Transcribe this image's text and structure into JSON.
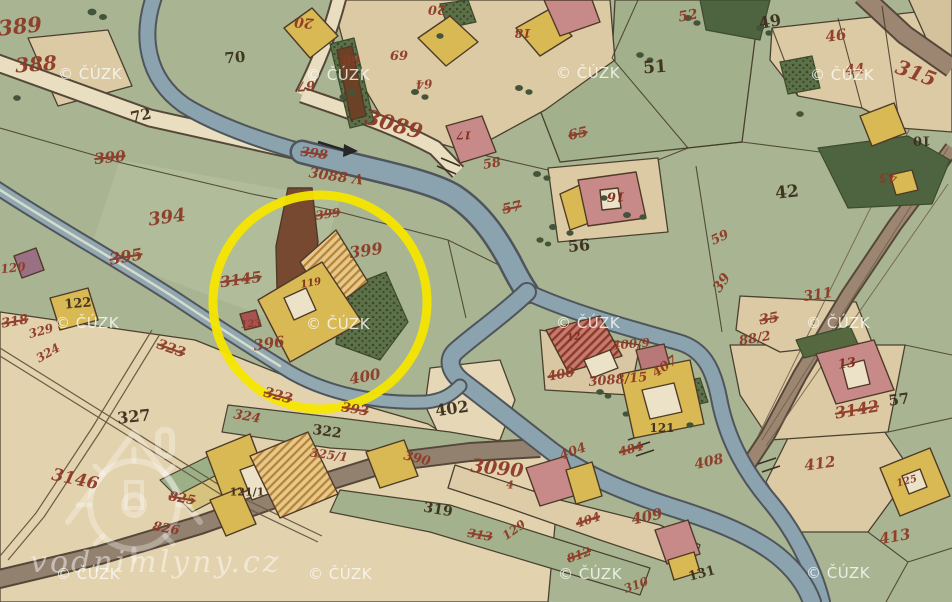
{
  "palette": {
    "field_green": "#a9b592",
    "parcel_beige": "#dccaa4",
    "road_beige": "#e9debf",
    "road_brown": "#9c8672",
    "water_blue": "#8ba3ae",
    "building_yellow": "#d9b954",
    "building_pink": "#c88a88",
    "garden_dark_green": "#5d7148",
    "number_red": "#8d3a27",
    "number_black": "#3b2e1e",
    "highlight_yellow": "#f6e600"
  },
  "highlight": {
    "shape": "circle",
    "cx": 320,
    "cy": 302,
    "r": 107,
    "color": "#f6e600",
    "stroke_width": 9
  },
  "watermark": {
    "text": "© ČÚZK",
    "positions": [
      {
        "x": 90,
        "y": 74
      },
      {
        "x": 338,
        "y": 75
      },
      {
        "x": 588,
        "y": 73
      },
      {
        "x": 842,
        "y": 75
      },
      {
        "x": 87,
        "y": 323
      },
      {
        "x": 338,
        "y": 324
      },
      {
        "x": 588,
        "y": 323
      },
      {
        "x": 838,
        "y": 323
      },
      {
        "x": 88,
        "y": 574
      },
      {
        "x": 340,
        "y": 574
      },
      {
        "x": 590,
        "y": 574
      },
      {
        "x": 838,
        "y": 573
      }
    ]
  },
  "logo": {
    "text": "vodnimlyny.cz"
  },
  "map": {
    "labels": [
      {
        "t": "389",
        "x": 20,
        "y": 26,
        "c": "red",
        "s": 21,
        "r": -6
      },
      {
        "t": "388",
        "x": 36,
        "y": 64,
        "c": "red",
        "s": 20,
        "r": -4
      },
      {
        "t": "72",
        "x": 141,
        "y": 116,
        "c": "black",
        "s": 15,
        "r": -12
      },
      {
        "t": "70",
        "x": 235,
        "y": 58,
        "c": "black",
        "s": 15,
        "r": -5
      },
      {
        "t": "20",
        "x": 304,
        "y": 22,
        "c": "red",
        "s": 14,
        "r": 185
      },
      {
        "t": "20",
        "x": 437,
        "y": 9,
        "c": "red",
        "s": 13,
        "r": 180
      },
      {
        "t": "66",
        "x": 351,
        "y": 59,
        "c": "red",
        "s": 13,
        "r": 175
      },
      {
        "t": "69",
        "x": 399,
        "y": 54,
        "c": "red",
        "s": 13,
        "r": 180
      },
      {
        "t": "64",
        "x": 424,
        "y": 84,
        "c": "red",
        "s": 12,
        "r": 175
      },
      {
        "t": "67",
        "x": 306,
        "y": 85,
        "c": "red",
        "s": 13,
        "r": 175
      },
      {
        "t": "18",
        "x": 523,
        "y": 33,
        "c": "red",
        "s": 12,
        "r": 180
      },
      {
        "t": "52",
        "x": 688,
        "y": 16,
        "c": "red",
        "s": 14,
        "r": -10
      },
      {
        "t": "51",
        "x": 655,
        "y": 68,
        "c": "black",
        "s": 17,
        "r": -4
      },
      {
        "t": "49",
        "x": 770,
        "y": 22,
        "c": "black",
        "s": 16,
        "r": -10
      },
      {
        "t": "46",
        "x": 836,
        "y": 36,
        "c": "red",
        "s": 15,
        "r": -8
      },
      {
        "t": "44",
        "x": 855,
        "y": 70,
        "c": "red",
        "s": 14,
        "r": -6
      },
      {
        "t": "315",
        "x": 916,
        "y": 73,
        "c": "red",
        "s": 20,
        "r": 20
      },
      {
        "t": "10",
        "x": 922,
        "y": 140,
        "c": "black",
        "s": 13,
        "r": 180
      },
      {
        "t": "65",
        "x": 578,
        "y": 134,
        "c": "red",
        "s": 14,
        "r": -12,
        "k": true
      },
      {
        "t": "17",
        "x": 464,
        "y": 135,
        "c": "dark",
        "s": 11,
        "r": 180
      },
      {
        "t": "16",
        "x": 616,
        "y": 196,
        "c": "dark",
        "s": 13,
        "r": 180
      },
      {
        "t": "56",
        "x": 579,
        "y": 246,
        "c": "black",
        "s": 16,
        "r": -5
      },
      {
        "t": "57",
        "x": 512,
        "y": 208,
        "c": "red",
        "s": 14,
        "r": -12,
        "k": true
      },
      {
        "t": "58",
        "x": 492,
        "y": 164,
        "c": "red",
        "s": 13,
        "r": -10
      },
      {
        "t": "42",
        "x": 787,
        "y": 193,
        "c": "black",
        "s": 17,
        "r": -6
      },
      {
        "t": "45",
        "x": 888,
        "y": 177,
        "c": "red",
        "s": 13,
        "r": 185
      },
      {
        "t": "59",
        "x": 720,
        "y": 238,
        "c": "red",
        "s": 13,
        "r": -25
      },
      {
        "t": "39",
        "x": 722,
        "y": 283,
        "c": "red",
        "s": 14,
        "r": -55
      },
      {
        "t": "311",
        "x": 818,
        "y": 295,
        "c": "red",
        "s": 14,
        "r": -8
      },
      {
        "t": "35",
        "x": 769,
        "y": 319,
        "c": "red",
        "s": 14,
        "r": -10,
        "k": true
      },
      {
        "t": "3089",
        "x": 394,
        "y": 124,
        "c": "red",
        "s": 21,
        "r": 16
      },
      {
        "t": "398",
        "x": 314,
        "y": 154,
        "c": "red",
        "s": 13,
        "r": 8,
        "k": true
      },
      {
        "t": "3088 Λ",
        "x": 336,
        "y": 177,
        "c": "red",
        "s": 14,
        "r": 8
      },
      {
        "t": "390",
        "x": 110,
        "y": 158,
        "c": "red",
        "s": 15,
        "r": -6,
        "k": true
      },
      {
        "t": "394",
        "x": 167,
        "y": 218,
        "c": "red",
        "s": 18,
        "r": -8
      },
      {
        "t": "395",
        "x": 126,
        "y": 257,
        "c": "red",
        "s": 16,
        "r": -10,
        "k": true
      },
      {
        "t": "120",
        "x": 13,
        "y": 268,
        "c": "red",
        "s": 12,
        "r": -6
      },
      {
        "t": "122",
        "x": 78,
        "y": 304,
        "c": "black",
        "s": 13,
        "r": -5
      },
      {
        "t": "318",
        "x": 15,
        "y": 322,
        "c": "red",
        "s": 13,
        "r": -10,
        "k": true
      },
      {
        "t": "329",
        "x": 41,
        "y": 331,
        "c": "red",
        "s": 12,
        "r": -15
      },
      {
        "t": "324",
        "x": 48,
        "y": 353,
        "c": "red",
        "s": 12,
        "r": -30
      },
      {
        "t": "3145",
        "x": 241,
        "y": 280,
        "c": "red",
        "s": 15,
        "r": -8,
        "k": true
      },
      {
        "t": "119",
        "x": 311,
        "y": 284,
        "c": "dark",
        "s": 10,
        "r": -10
      },
      {
        "t": "123",
        "x": 251,
        "y": 325,
        "c": "red",
        "s": 10,
        "r": -5
      },
      {
        "t": "399",
        "x": 366,
        "y": 251,
        "c": "red",
        "s": 16,
        "r": -8
      },
      {
        "t": "399",
        "x": 328,
        "y": 214,
        "c": "red",
        "s": 12,
        "r": -8,
        "k": true
      },
      {
        "t": "396",
        "x": 269,
        "y": 344,
        "c": "red",
        "s": 15,
        "r": -8
      },
      {
        "t": "400",
        "x": 365,
        "y": 377,
        "c": "red",
        "s": 15,
        "r": -10
      },
      {
        "t": "402",
        "x": 452,
        "y": 409,
        "c": "black",
        "s": 16,
        "r": -8
      },
      {
        "t": "323",
        "x": 171,
        "y": 349,
        "c": "red",
        "s": 14,
        "r": 20,
        "k": true
      },
      {
        "t": "323",
        "x": 278,
        "y": 396,
        "c": "red",
        "s": 14,
        "r": 15,
        "k": true
      },
      {
        "t": "324",
        "x": 247,
        "y": 417,
        "c": "red",
        "s": 13,
        "r": 10
      },
      {
        "t": "393",
        "x": 355,
        "y": 410,
        "c": "red",
        "s": 13,
        "r": 10,
        "k": true
      },
      {
        "t": "322",
        "x": 327,
        "y": 432,
        "c": "black",
        "s": 14,
        "r": 8
      },
      {
        "t": "325/1",
        "x": 329,
        "y": 455,
        "c": "red",
        "s": 12,
        "r": 8
      },
      {
        "t": "390",
        "x": 417,
        "y": 459,
        "c": "red",
        "s": 13,
        "r": 14
      },
      {
        "t": "319",
        "x": 438,
        "y": 510,
        "c": "black",
        "s": 14,
        "r": 10
      },
      {
        "t": "327",
        "x": 134,
        "y": 417,
        "c": "black",
        "s": 16,
        "r": -6
      },
      {
        "t": "3146",
        "x": 75,
        "y": 480,
        "c": "red",
        "s": 17,
        "r": 12
      },
      {
        "t": "825",
        "x": 182,
        "y": 499,
        "c": "red",
        "s": 13,
        "r": 10,
        "k": true
      },
      {
        "t": "826",
        "x": 166,
        "y": 529,
        "c": "red",
        "s": 13,
        "r": 10
      },
      {
        "t": "121/1",
        "x": 247,
        "y": 492,
        "c": "black",
        "s": 11,
        "r": 0
      },
      {
        "t": "313",
        "x": 480,
        "y": 535,
        "c": "red",
        "s": 12,
        "r": 10,
        "k": true
      },
      {
        "t": "3090",
        "x": 497,
        "y": 469,
        "c": "red",
        "s": 19,
        "r": 6
      },
      {
        "t": "4",
        "x": 510,
        "y": 485,
        "c": "red",
        "s": 11,
        "r": 0
      },
      {
        "t": "404",
        "x": 573,
        "y": 452,
        "c": "red",
        "s": 13,
        "r": -20
      },
      {
        "t": "484",
        "x": 631,
        "y": 449,
        "c": "red",
        "s": 12,
        "r": -15,
        "k": true
      },
      {
        "t": "121",
        "x": 662,
        "y": 428,
        "c": "black",
        "s": 12,
        "r": 0
      },
      {
        "t": "12",
        "x": 574,
        "y": 338,
        "c": "dark",
        "s": 10,
        "r": -10
      },
      {
        "t": "400",
        "x": 561,
        "y": 375,
        "c": "red",
        "s": 13,
        "r": -10,
        "k": true
      },
      {
        "t": "400/9",
        "x": 631,
        "y": 344,
        "c": "red",
        "s": 12,
        "r": -5
      },
      {
        "t": "3088/15",
        "x": 618,
        "y": 380,
        "c": "red",
        "s": 13,
        "r": -5
      },
      {
        "t": "407",
        "x": 665,
        "y": 367,
        "c": "red",
        "s": 13,
        "r": -35
      },
      {
        "t": "88/2",
        "x": 755,
        "y": 339,
        "c": "red",
        "s": 13,
        "r": -10
      },
      {
        "t": "13",
        "x": 847,
        "y": 364,
        "c": "dark",
        "s": 13,
        "r": -8
      },
      {
        "t": "3142",
        "x": 857,
        "y": 410,
        "c": "red",
        "s": 16,
        "r": -10,
        "k": true
      },
      {
        "t": "57",
        "x": 899,
        "y": 400,
        "c": "black",
        "s": 15,
        "r": -8
      },
      {
        "t": "412",
        "x": 820,
        "y": 464,
        "c": "red",
        "s": 15,
        "r": -8
      },
      {
        "t": "408",
        "x": 709,
        "y": 462,
        "c": "red",
        "s": 14,
        "r": -12
      },
      {
        "t": "413",
        "x": 895,
        "y": 537,
        "c": "red",
        "s": 15,
        "r": -10
      },
      {
        "t": "125",
        "x": 907,
        "y": 482,
        "c": "red",
        "s": 10,
        "r": -15
      },
      {
        "t": "131",
        "x": 702,
        "y": 574,
        "c": "black",
        "s": 13,
        "r": -15
      },
      {
        "t": "129",
        "x": 514,
        "y": 530,
        "c": "red",
        "s": 12,
        "r": -35
      },
      {
        "t": "812",
        "x": 579,
        "y": 555,
        "c": "red",
        "s": 12,
        "r": -20,
        "k": true
      },
      {
        "t": "310",
        "x": 636,
        "y": 585,
        "c": "red",
        "s": 12,
        "r": -20
      },
      {
        "t": "409",
        "x": 647,
        "y": 517,
        "c": "red",
        "s": 15,
        "r": -12
      },
      {
        "t": "404",
        "x": 588,
        "y": 520,
        "c": "red",
        "s": 12,
        "r": -18,
        "k": true
      }
    ]
  }
}
